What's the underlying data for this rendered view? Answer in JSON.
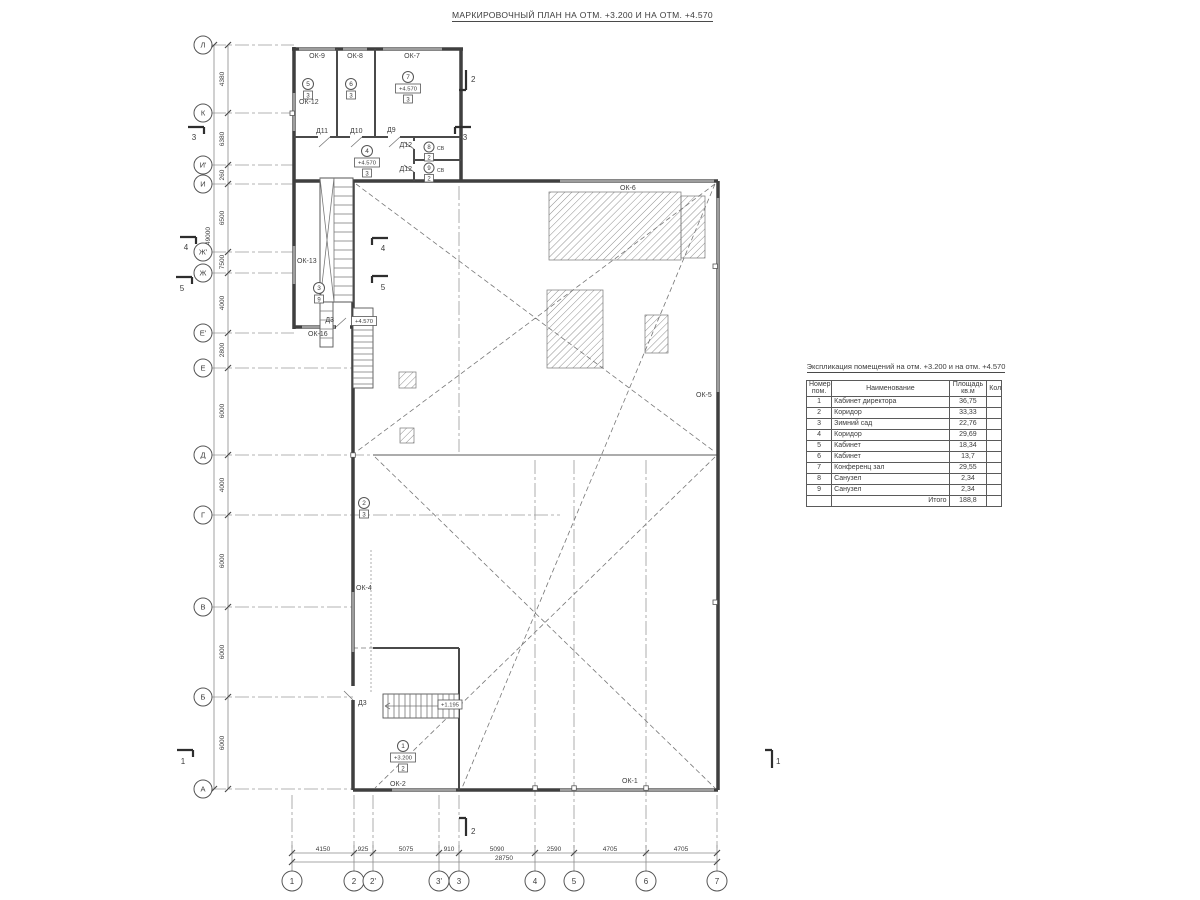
{
  "page_title": "МАРКИРОВОЧНЫЙ ПЛАН НА ОТМ. +3.200 И НА ОТМ. +4.570",
  "axes": {
    "rows": [
      "Л",
      "К",
      "И'",
      "И",
      "Ж'",
      "Ж",
      "Е'",
      "Е",
      "Д",
      "Г",
      "В",
      "Б",
      "А"
    ],
    "cols": [
      "1",
      "2",
      "2'",
      "3'",
      "3",
      "4",
      "5",
      "6",
      "7"
    ]
  },
  "dims": {
    "left": [
      "4380",
      "6380",
      "260",
      "6500",
      "7500",
      "4000",
      "2800",
      "6000",
      "4000",
      "6000",
      "6000",
      "6000"
    ],
    "left_total": "49000",
    "bottom": [
      "4150",
      "925",
      "5075",
      "910",
      "5090",
      "2590",
      "4705",
      "4705"
    ],
    "bottom_total": "28750"
  },
  "windows": {
    "ok1": "ОК-1",
    "ok2": "ОК-2",
    "ok4": "ОК-4",
    "ok5": "ОК-5",
    "ok6": "ОК-6",
    "ok7": "ОК-7",
    "ok8": "ОК-8",
    "ok9": "ОК-9",
    "ok12": "ОК-12",
    "ok13": "ОК-13",
    "ok16": "ОК-16"
  },
  "doors": {
    "d3": "Д3",
    "d9": "Д9",
    "d10": "Д10",
    "d11": "Д11",
    "d12": "Д12"
  },
  "marks": {
    "elev_4570": "+4.570",
    "elev_3200": "+3.200",
    "elev_stair": "+1.195",
    "vent": "СВ"
  },
  "rooms": [
    {
      "num": "1",
      "floor": "2"
    },
    {
      "num": "2",
      "floor": "3"
    },
    {
      "num": "3",
      "floor": "9"
    },
    {
      "num": "4",
      "floor": "3"
    },
    {
      "num": "5",
      "floor": "3"
    },
    {
      "num": "6",
      "floor": "3"
    },
    {
      "num": "7",
      "floor": "3"
    },
    {
      "num": "8",
      "floor": "2"
    },
    {
      "num": "9",
      "floor": "2"
    }
  ],
  "sections": {
    "s1": "1",
    "s2": "2",
    "s3": "3",
    "s4": "4",
    "s5": "5"
  },
  "table": {
    "title": "Экспликация помещений на отм. +3.200 и на отм. +4.570",
    "headers": [
      "Номер пом.",
      "Наименование",
      "Площадь кв.м",
      "Кол."
    ],
    "rows": [
      {
        "n": "1",
        "name": "Кабинет директора",
        "area": "36,75"
      },
      {
        "n": "2",
        "name": "Коридор",
        "area": "33,33"
      },
      {
        "n": "3",
        "name": "Зимний сад",
        "area": "22,76"
      },
      {
        "n": "4",
        "name": "Коридор",
        "area": "29,69"
      },
      {
        "n": "5",
        "name": "Кабинет",
        "area": "18,34"
      },
      {
        "n": "6",
        "name": "Кабинет",
        "area": "13,7"
      },
      {
        "n": "7",
        "name": "Конференц зал",
        "area": "29,55"
      },
      {
        "n": "8",
        "name": "Санузел",
        "area": "2,34"
      },
      {
        "n": "9",
        "name": "Санузел",
        "area": "2,34"
      }
    ],
    "total_label": "Итого",
    "total_value": "188,8"
  },
  "colors": {
    "line": "#3f3f3f",
    "thin": "#777777",
    "glass": "#9d9d9d",
    "background": "#ffffff"
  }
}
